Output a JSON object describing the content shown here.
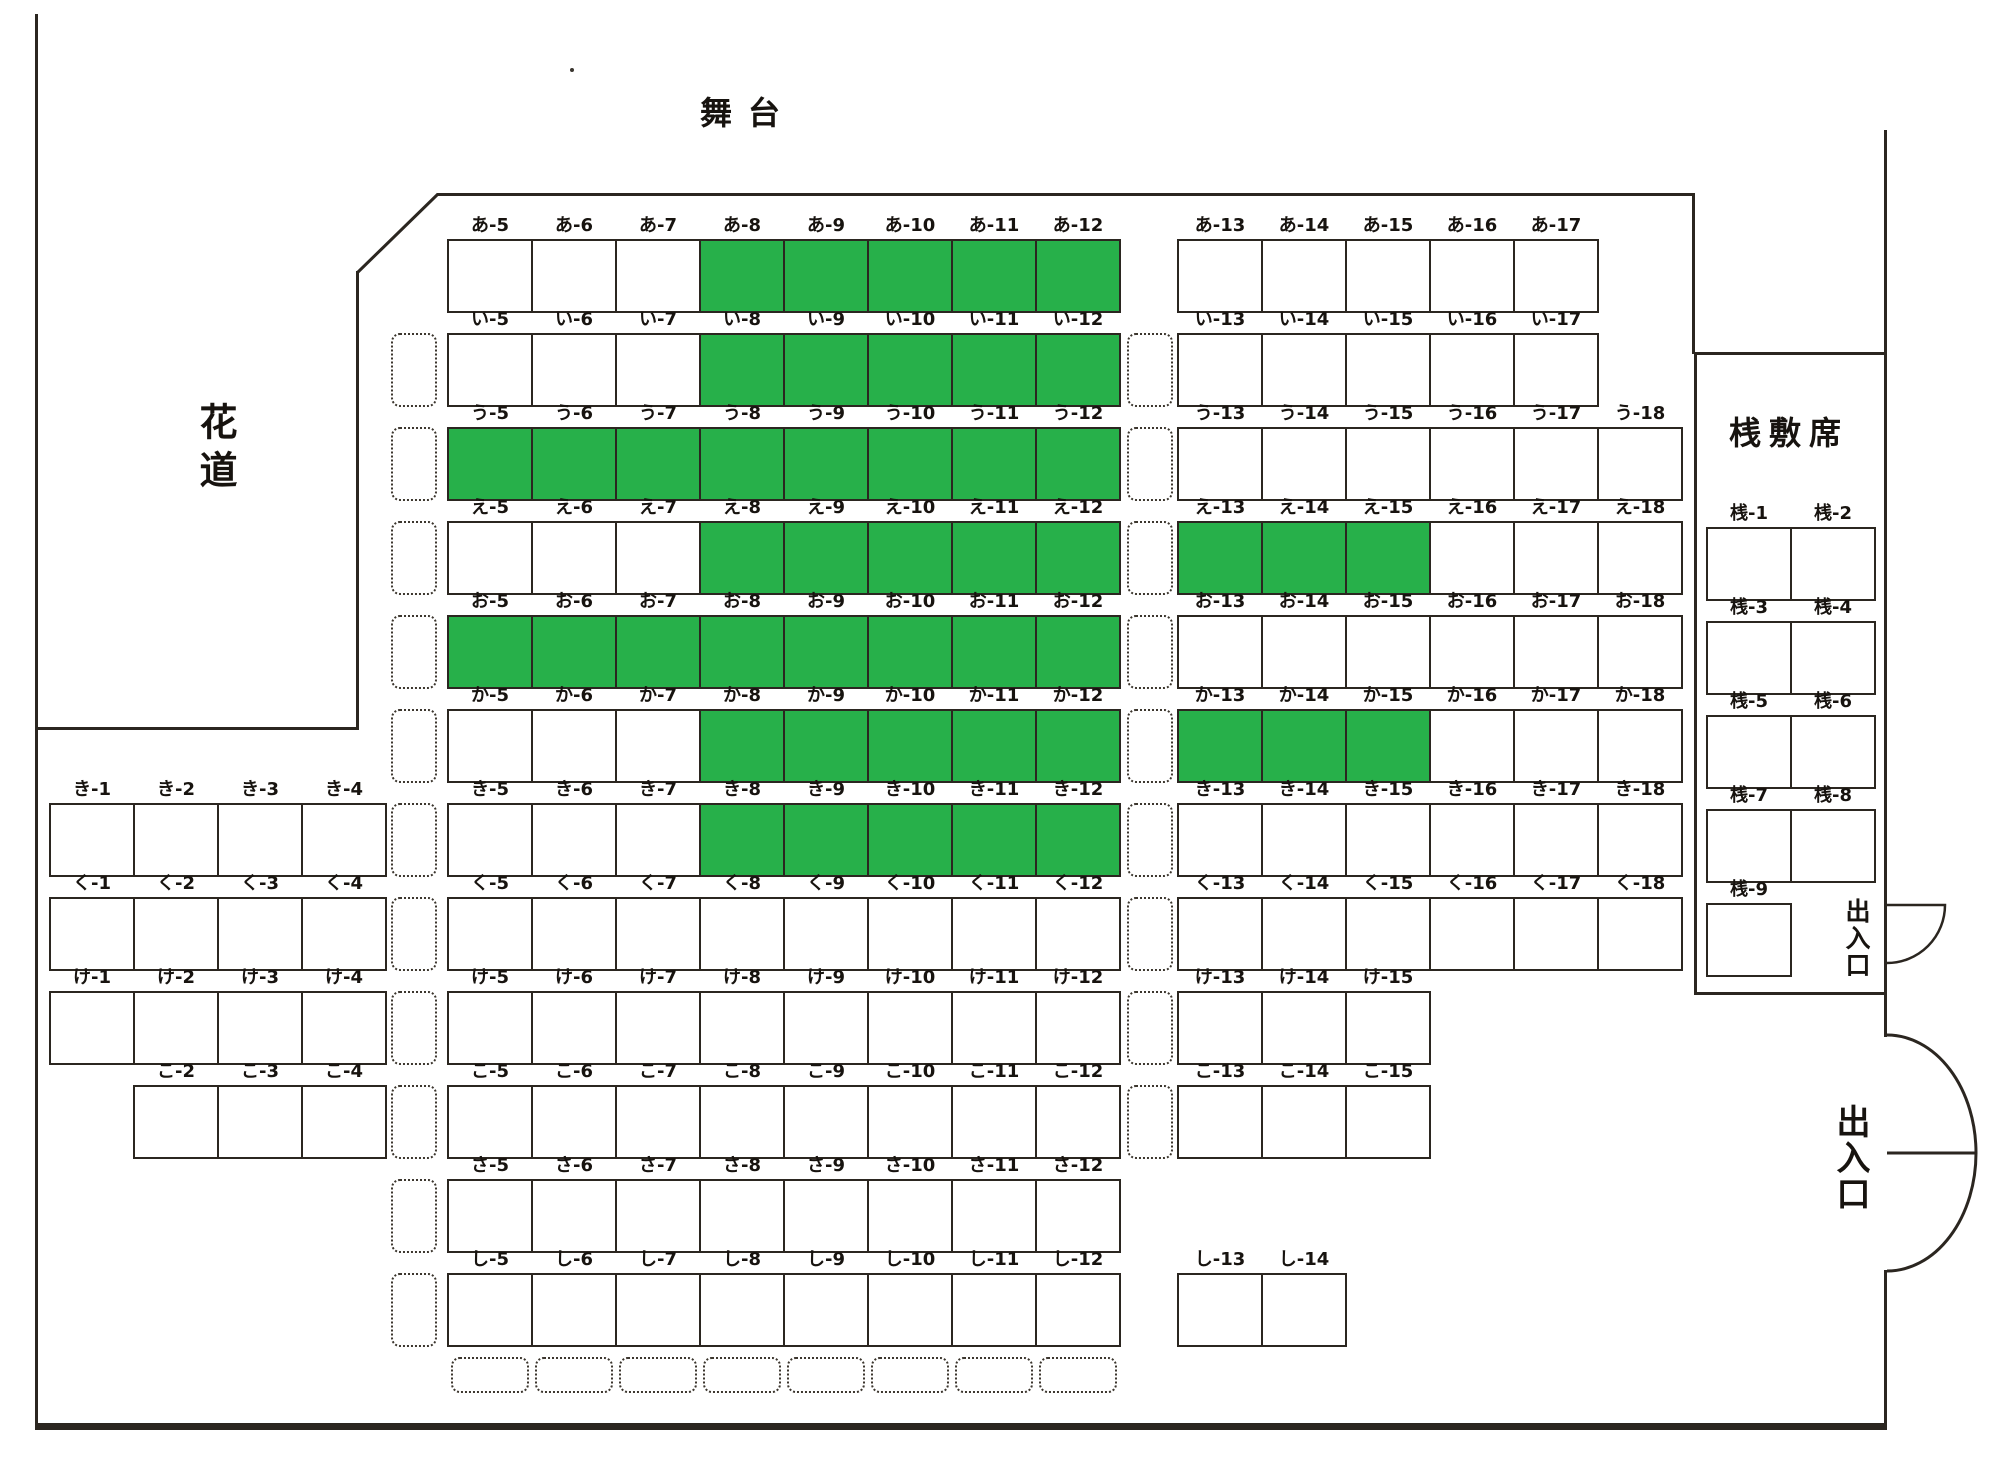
{
  "labels": {
    "stage": "舞台",
    "hanamichi": "花道",
    "sajiki_section": "桟敷席",
    "entrance": "出入口",
    "sajiki_row_prefix": "桟"
  },
  "colors": {
    "seat_available_fill": "#ffffff",
    "seat_selected_fill": "#27b04a",
    "line_color": "#2b2620"
  },
  "seating": {
    "rows": [
      {
        "name": "あ",
        "seats": [
          5,
          6,
          7,
          8,
          9,
          10,
          11,
          12,
          13,
          14,
          15,
          16,
          17
        ],
        "selected": [
          8,
          9,
          10,
          11,
          12
        ],
        "aisle_boxes": []
      },
      {
        "name": "い",
        "seats": [
          5,
          6,
          7,
          8,
          9,
          10,
          11,
          12,
          13,
          14,
          15,
          16,
          17
        ],
        "selected": [
          8,
          9,
          10,
          11,
          12
        ],
        "aisle_boxes": [
          "left",
          "right"
        ]
      },
      {
        "name": "う",
        "seats": [
          5,
          6,
          7,
          8,
          9,
          10,
          11,
          12,
          13,
          14,
          15,
          16,
          17,
          18
        ],
        "selected": [
          5,
          6,
          7,
          8,
          9,
          10,
          11,
          12
        ],
        "aisle_boxes": [
          "left",
          "right"
        ]
      },
      {
        "name": "え",
        "seats": [
          5,
          6,
          7,
          8,
          9,
          10,
          11,
          12,
          13,
          14,
          15,
          16,
          17,
          18
        ],
        "selected": [
          8,
          9,
          10,
          11,
          12,
          13,
          14,
          15
        ],
        "aisle_boxes": [
          "left",
          "right"
        ]
      },
      {
        "name": "お",
        "seats": [
          5,
          6,
          7,
          8,
          9,
          10,
          11,
          12,
          13,
          14,
          15,
          16,
          17,
          18
        ],
        "selected": [
          5,
          6,
          7,
          8,
          9,
          10,
          11,
          12
        ],
        "aisle_boxes": [
          "left",
          "right"
        ]
      },
      {
        "name": "か",
        "seats": [
          5,
          6,
          7,
          8,
          9,
          10,
          11,
          12,
          13,
          14,
          15,
          16,
          17,
          18
        ],
        "selected": [
          8,
          9,
          10,
          11,
          12,
          13,
          14,
          15
        ],
        "aisle_boxes": [
          "left",
          "right"
        ]
      },
      {
        "name": "き",
        "seats": [
          1,
          2,
          3,
          4,
          5,
          6,
          7,
          8,
          9,
          10,
          11,
          12,
          13,
          14,
          15,
          16,
          17,
          18
        ],
        "selected": [
          8,
          9,
          10,
          11,
          12
        ],
        "aisle_boxes": [
          "left",
          "right"
        ]
      },
      {
        "name": "く",
        "seats": [
          1,
          2,
          3,
          4,
          5,
          6,
          7,
          8,
          9,
          10,
          11,
          12,
          13,
          14,
          15,
          16,
          17,
          18
        ],
        "selected": [],
        "aisle_boxes": [
          "left",
          "right"
        ]
      },
      {
        "name": "け",
        "seats": [
          1,
          2,
          3,
          4,
          5,
          6,
          7,
          8,
          9,
          10,
          11,
          12,
          13,
          14,
          15
        ],
        "selected": [],
        "aisle_boxes": [
          "left",
          "right"
        ]
      },
      {
        "name": "こ",
        "seats": [
          2,
          3,
          4,
          5,
          6,
          7,
          8,
          9,
          10,
          11,
          12,
          13,
          14,
          15
        ],
        "selected": [],
        "aisle_boxes": [
          "left",
          "right"
        ]
      },
      {
        "name": "さ",
        "seats": [
          5,
          6,
          7,
          8,
          9,
          10,
          11,
          12
        ],
        "selected": [],
        "aisle_boxes": [
          "left"
        ]
      },
      {
        "name": "し",
        "seats": [
          5,
          6,
          7,
          8,
          9,
          10,
          11,
          12,
          13,
          14
        ],
        "selected": [],
        "aisle_boxes": [
          "left"
        ]
      }
    ],
    "bottom_placeholder_cols": [
      5,
      6,
      7,
      8,
      9,
      10,
      11,
      12
    ],
    "sajiki_seats": [
      "桟-1",
      "桟-2",
      "桟-3",
      "桟-4",
      "桟-5",
      "桟-6",
      "桟-7",
      "桟-8",
      "桟-9"
    ]
  }
}
